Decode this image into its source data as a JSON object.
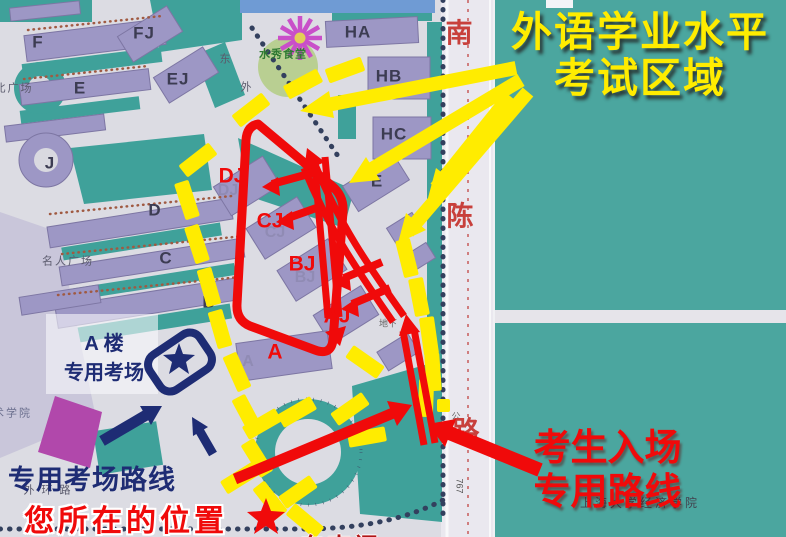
{
  "colors": {
    "yellow": "#ffec00",
    "red": "#f00a0a",
    "navy": "#1e2c74",
    "map-teal": "#3fa19a",
    "panel-teal": "#4ba69f",
    "lavender": "#9d97c5",
    "road-label-red": "#c8403c"
  },
  "annotations": {
    "exam_title_line1": "外语学业水平",
    "exam_title_line2": "考试区域",
    "entry_line1": "考生入场",
    "entry_line2": "专用路线",
    "location_label": "您所在的位置",
    "special_route_label": "专用考场路线",
    "a_building_line1": "A 楼",
    "a_building_line2": "专用考场",
    "gate_label": "东南门"
  },
  "exam_room_labels": [
    {
      "t": "DJ",
      "x": 232,
      "y": 176
    },
    {
      "t": "CJ",
      "x": 270,
      "y": 221
    },
    {
      "t": "BJ",
      "x": 302,
      "y": 264
    },
    {
      "t": "AJ",
      "x": 337,
      "y": 316
    },
    {
      "t": "A",
      "x": 275,
      "y": 352
    }
  ],
  "map_building_labels": [
    {
      "t": "F",
      "x": 38,
      "y": 42
    },
    {
      "t": "FJ",
      "x": 144,
      "y": 33
    },
    {
      "t": "E",
      "x": 80,
      "y": 88
    },
    {
      "t": "EJ",
      "x": 178,
      "y": 79
    },
    {
      "t": "J",
      "x": 50,
      "y": 163
    },
    {
      "t": "D",
      "x": 155,
      "y": 210
    },
    {
      "t": "C",
      "x": 166,
      "y": 258
    },
    {
      "t": "B",
      "x": 209,
      "y": 302
    },
    {
      "t": "HA",
      "x": 358,
      "y": 32
    },
    {
      "t": "HB",
      "x": 389,
      "y": 76
    },
    {
      "t": "HC",
      "x": 394,
      "y": 134
    },
    {
      "t": "E",
      "x": 377,
      "y": 181
    }
  ],
  "map_faint_labels": [
    {
      "t": "DJ",
      "x": 228,
      "y": 191
    },
    {
      "t": "CJ",
      "x": 275,
      "y": 233
    },
    {
      "t": "BJ",
      "x": 305,
      "y": 278
    },
    {
      "t": "A",
      "x": 248,
      "y": 362
    }
  ],
  "map_place_labels": [
    {
      "t": "北广场",
      "x": 14,
      "y": 89
    },
    {
      "t": "名人广场",
      "x": 68,
      "y": 262
    },
    {
      "t": "水秀食堂",
      "x": 283,
      "y": 55,
      "cls": "canteen"
    },
    {
      "t": "美术学院",
      "x": 6,
      "y": 414,
      "cls": "dim"
    },
    {
      "t": "外 环 路",
      "x": 48,
      "y": 491
    },
    {
      "t": "上海大学经济学院",
      "x": 640,
      "y": 503,
      "cls": "college"
    },
    {
      "t": "东",
      "x": 226,
      "y": 60
    },
    {
      "t": "外",
      "x": 247,
      "y": 88
    },
    {
      "t": "公",
      "x": 456,
      "y": 417,
      "cls": "tiny"
    },
    {
      "t": "地下",
      "x": 388,
      "y": 324,
      "cls": "tiny"
    },
    {
      "t": "767",
      "x": 459,
      "y": 486,
      "cls": "bus"
    }
  ],
  "road_labels": [
    {
      "t": "南",
      "x": 459,
      "y": 34
    },
    {
      "t": "陈",
      "x": 460,
      "y": 217
    },
    {
      "t": "路",
      "x": 466,
      "y": 432
    }
  ]
}
